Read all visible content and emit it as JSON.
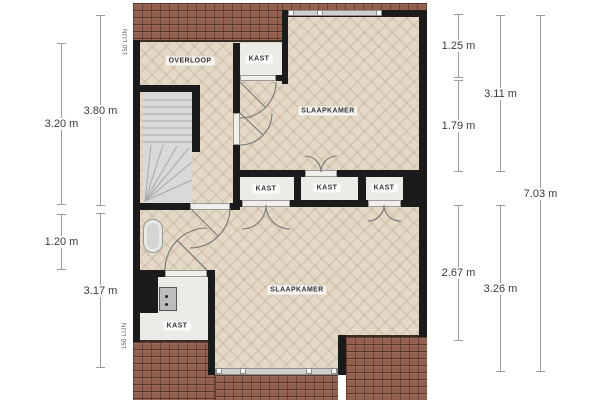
{
  "floor_plan": {
    "rooms": {
      "overloop": "OVERLOOP",
      "kast_top": "KAST",
      "slaapkamer_top": "SLAAPKAMER",
      "kast_mid_1": "KAST",
      "kast_mid_2": "KAST",
      "kast_mid_3": "KAST",
      "slaapkamer_bottom": "SLAAPKAMER",
      "kast_bottom": "KAST"
    },
    "annotations": {
      "line_150_top": "150 LIJN",
      "line_150_bottom": "150 LIJN"
    },
    "fixtures": [
      "sink",
      "appliance",
      "staircase",
      "chimney"
    ]
  },
  "dims": {
    "left_outer": [
      "3.20 m",
      "1.20 m"
    ],
    "left_inner": [
      "3.80 m",
      "3.17 m"
    ],
    "right_inner": [
      "1.25 m",
      "1.79 m",
      "2.67 m"
    ],
    "right_mid": [
      "3.11 m",
      "3.26 m"
    ],
    "right_outer": [
      "7.03 m"
    ]
  },
  "colors": {
    "roof": "#93604f",
    "roof_line": "#3a2d23",
    "floor": "#e4d8c6",
    "wall": "#1b1b1b",
    "closet_floor": "#ecebe8",
    "window": "#cfcfcf",
    "dimension_line": "#9a9a9a",
    "dimension_text": "#3a3a3a"
  }
}
